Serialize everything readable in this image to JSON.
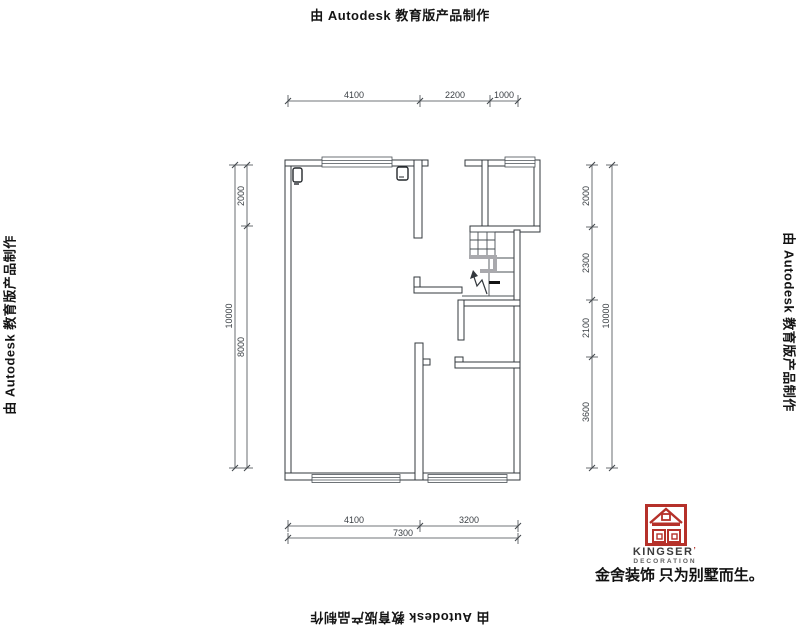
{
  "watermark": {
    "text": "由 Autodesk 教育版产品制作"
  },
  "dimensions": {
    "top": [
      "4100",
      "2200",
      "1000"
    ],
    "bottom_inner": [
      "4100",
      "3200"
    ],
    "bottom_total": "7300",
    "left_inner": [
      "2000",
      "8000"
    ],
    "left_total": "10000",
    "right_inner": [
      "2000",
      "2300",
      "2100",
      "3600"
    ],
    "right_total": "10000"
  },
  "logo": {
    "brand": "KINGSER",
    "mark": "’",
    "subtitle": "DECORATION",
    "tagline": "金舍装饰 只为别墅而生。",
    "accent_red": "#b5312a"
  }
}
